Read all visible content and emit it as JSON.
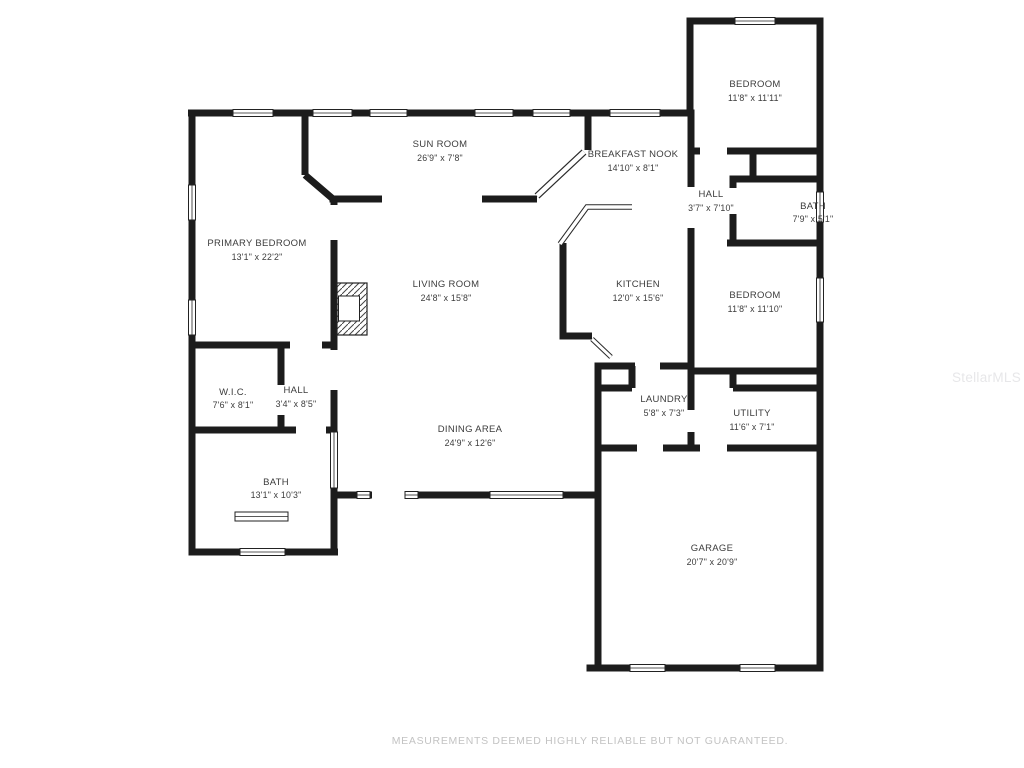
{
  "page": {
    "type": "residential-floor-plan",
    "footer_disclaimer": "MEASUREMENTS DEEMED HIGHLY RELIABLE BUT NOT GUARANTEED.",
    "watermark": "StellarMLS"
  },
  "colors": {
    "background": "#ffffff",
    "wall": "#1c1c1c",
    "label": "#3c3c3c",
    "footer_text": "#c3c3c3",
    "watermark": "#e7e7e9"
  },
  "rooms": [
    {
      "name": "BEDROOM",
      "dims": "11'8\" x 11'11\""
    },
    {
      "name": "SUN ROOM",
      "dims": "26'9\" x 7'8\""
    },
    {
      "name": "BREAKFAST NOOK",
      "dims": "14'10\" x 8'1\""
    },
    {
      "name": "HALL",
      "dims": "3'7\" x 7'10\""
    },
    {
      "name": "BATH",
      "dims": "7'9\" x 5'1\""
    },
    {
      "name": "PRIMARY BEDROOM",
      "dims": "13'1\" x 22'2\""
    },
    {
      "name": "LIVING ROOM",
      "dims": "24'8\" x 15'8\""
    },
    {
      "name": "KITCHEN",
      "dims": "12'0\" x 15'6\""
    },
    {
      "name": "BEDROOM",
      "dims": "11'8\" x 11'10\""
    },
    {
      "name": "W.I.C.",
      "dims": "7'6\" x 8'1\""
    },
    {
      "name": "HALL",
      "dims": "3'4\" x 8'5\""
    },
    {
      "name": "LAUNDRY",
      "dims": "5'8\" x 7'3\""
    },
    {
      "name": "UTILITY",
      "dims": "11'6\" x 7'1\""
    },
    {
      "name": "DINING AREA",
      "dims": "24'9\" x 12'6\""
    },
    {
      "name": "BATH",
      "dims": "13'1\" x 10'3\""
    },
    {
      "name": "GARAGE",
      "dims": "20'7\" x 20'9\""
    }
  ]
}
